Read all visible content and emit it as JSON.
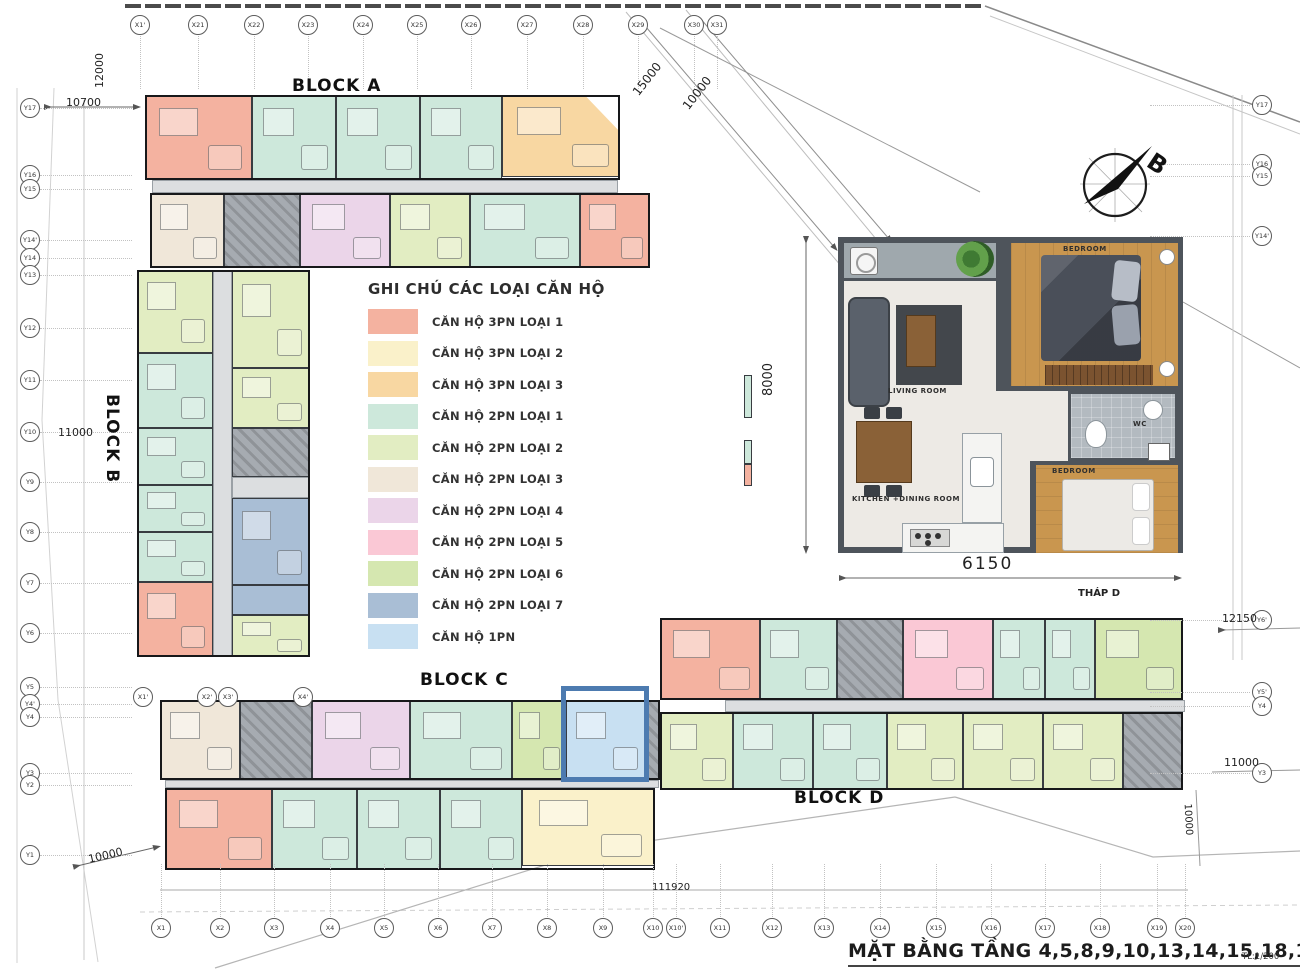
{
  "title": {
    "text": "MẶT BẰNG TẦNG 4,5,8,9,10,13,14,15,18,19,20",
    "scale": "TL:1/200"
  },
  "blocks": {
    "a": "BLOCK A",
    "b": "BLOCK B",
    "c": "BLOCK C",
    "d": "BLOCK D"
  },
  "north": {
    "label": "B"
  },
  "legend": {
    "title": "GHI CHÚ CÁC LOẠI CĂN HỘ",
    "items": [
      {
        "label": "CĂN HỘ 3PN LOẠI 1",
        "key": "3pn1",
        "color": "#f4b2a0"
      },
      {
        "label": "CĂN HỘ 3PN LOẠI 2",
        "key": "3pn2",
        "color": "#faf1ca"
      },
      {
        "label": "CĂN HỘ 3PN LOẠI 3",
        "key": "3pn3",
        "color": "#f8d7a2"
      },
      {
        "label": "CĂN HỘ 2PN LOẠI 1",
        "key": "2pn1",
        "color": "#cde8db"
      },
      {
        "label": "CĂN HỘ 2PN LOẠI 2",
        "key": "2pn2",
        "color": "#e2edc2"
      },
      {
        "label": "CĂN HỘ 2PN LOẠI 3",
        "key": "2pn3",
        "color": "#f0e7d9"
      },
      {
        "label": "CĂN HỘ 2PN LOẠI 4",
        "key": "2pn4",
        "color": "#ebd5e9"
      },
      {
        "label": "CĂN HỘ 2PN LOẠI 5",
        "key": "2pn5",
        "color": "#fac8d5"
      },
      {
        "label": "CĂN HỘ 2PN LOẠI 6",
        "key": "2pn6",
        "color": "#d5e7b0"
      },
      {
        "label": "CĂN HỘ 2PN LOẠI 7",
        "key": "2pn7",
        "color": "#a9bed5"
      },
      {
        "label": "CĂN HỘ 1PN",
        "key": "1pn",
        "color": "#c8e0f2"
      }
    ]
  },
  "detail": {
    "rooms": {
      "living": "LIVING ROOM",
      "kitchen": "KITCHEN +DINING ROOM",
      "bedroom": "BEDROOM",
      "wc": "WC"
    },
    "width_dim": "6150",
    "height_dim": "8000",
    "tower": "THÁP D"
  },
  "dims": {
    "top_vert": "12000",
    "left_top": "10700",
    "left_mid": "11000",
    "left_bottom": "10000",
    "diag_a": "15000",
    "diag_b": "10000",
    "right_top": "12150",
    "right_mid": "11000",
    "right_vert": "10000",
    "bottom_total": "111920"
  },
  "axes": {
    "top": [
      [
        "X1'",
        140
      ],
      [
        "X21",
        198
      ],
      [
        "X22",
        254
      ],
      [
        "X23",
        308
      ],
      [
        "X24",
        363
      ],
      [
        "X25",
        417
      ],
      [
        "X26",
        471
      ],
      [
        "X27",
        527
      ],
      [
        "X28",
        583
      ],
      [
        "X29",
        638
      ],
      [
        "X30",
        694
      ],
      [
        "X31",
        717
      ]
    ],
    "top_y": 25,
    "bottom": [
      [
        "X1",
        161
      ],
      [
        "X2",
        220
      ],
      [
        "X3",
        274
      ],
      [
        "X4",
        330
      ],
      [
        "X5",
        384
      ],
      [
        "X6",
        438
      ],
      [
        "X7",
        492
      ],
      [
        "X8",
        547
      ],
      [
        "X9",
        603
      ],
      [
        "X10",
        653
      ],
      [
        "X10'",
        676
      ],
      [
        "X11",
        720
      ],
      [
        "X12",
        772
      ],
      [
        "X13",
        824
      ],
      [
        "X14",
        880
      ],
      [
        "X15",
        936
      ],
      [
        "X16",
        991
      ],
      [
        "X17",
        1045
      ],
      [
        "X18",
        1100
      ],
      [
        "X19",
        1157
      ],
      [
        "X20",
        1185
      ]
    ],
    "bottom_y": 928,
    "left": [
      [
        "Y17",
        108
      ],
      [
        "Y16",
        175
      ],
      [
        "Y15",
        189
      ],
      [
        "Y14'",
        240
      ],
      [
        "Y14",
        258
      ],
      [
        "Y13",
        275
      ],
      [
        "Y12",
        328
      ],
      [
        "Y11",
        380
      ],
      [
        "Y10",
        432
      ],
      [
        "Y9",
        482
      ],
      [
        "Y8",
        532
      ],
      [
        "Y7",
        583
      ],
      [
        "Y6",
        633
      ],
      [
        "Y5",
        687
      ],
      [
        "Y4'",
        704
      ],
      [
        "Y4",
        717
      ],
      [
        "Y3",
        773
      ],
      [
        "Y2",
        785
      ],
      [
        "Y1",
        855
      ]
    ],
    "left_x": 30,
    "right": [
      [
        "Y17",
        105
      ],
      [
        "Y16",
        164
      ],
      [
        "Y15",
        176
      ],
      [
        "Y14'",
        236
      ],
      [
        "Y6'",
        620
      ],
      [
        "Y5'",
        692
      ],
      [
        "Y4",
        706
      ],
      [
        "Y3",
        773
      ]
    ],
    "right_x": 1262,
    "mid": [
      [
        "X1'",
        143,
        697
      ],
      [
        "X2'",
        207,
        697
      ],
      [
        "X3'",
        228,
        697
      ],
      [
        "X4'",
        303,
        697
      ]
    ]
  },
  "plan": {
    "colors": {
      "3pn1": "#f4b2a0",
      "3pn2": "#faf1ca",
      "3pn3": "#f8d7a2",
      "2pn1": "#cde8db",
      "2pn2": "#e2edc2",
      "2pn3": "#f0e7d9",
      "2pn4": "#ebd5e9",
      "2pn5": "#fac8d5",
      "2pn6": "#d5e7b0",
      "2pn7": "#a9bed5",
      "1pn": "#c8e0f2",
      "core": "#a6abb1",
      "corr": "#dcdee0"
    },
    "units": [
      [
        145,
        95,
        107,
        85,
        "3pn1"
      ],
      [
        252,
        95,
        84,
        85,
        "2pn1"
      ],
      [
        336,
        95,
        84,
        85,
        "2pn1"
      ],
      [
        420,
        95,
        82,
        85,
        "2pn1"
      ],
      [
        502,
        95,
        118,
        82,
        "3pn3",
        "polygon(0 0,70% 0,100% 45%,100% 100%,0 100%)"
      ],
      [
        152,
        180,
        466,
        13,
        "corr"
      ],
      [
        150,
        193,
        74,
        75,
        "2pn3"
      ],
      [
        224,
        193,
        76,
        75,
        "core"
      ],
      [
        300,
        193,
        90,
        75,
        "2pn4"
      ],
      [
        390,
        193,
        80,
        75,
        "2pn2"
      ],
      [
        470,
        193,
        110,
        75,
        "2pn1"
      ],
      [
        580,
        193,
        70,
        75,
        "3pn1"
      ],
      [
        213,
        270,
        19,
        387,
        "corr"
      ],
      [
        137,
        270,
        76,
        83,
        "2pn2"
      ],
      [
        137,
        353,
        76,
        75,
        "2pn1"
      ],
      [
        137,
        428,
        76,
        57,
        "2pn1"
      ],
      [
        137,
        485,
        76,
        47,
        "2pn1"
      ],
      [
        137,
        532,
        76,
        50,
        "2pn1"
      ],
      [
        137,
        582,
        76,
        75,
        "3pn1"
      ],
      [
        232,
        270,
        78,
        98,
        "2pn2"
      ],
      [
        232,
        368,
        78,
        60,
        "2pn2"
      ],
      [
        232,
        428,
        78,
        49,
        "core"
      ],
      [
        232,
        477,
        78,
        21,
        "corr"
      ],
      [
        232,
        498,
        78,
        87,
        "2pn7"
      ],
      [
        232,
        585,
        78,
        30,
        "2pn7"
      ],
      [
        232,
        615,
        78,
        42,
        "2pn2"
      ],
      [
        160,
        700,
        80,
        80,
        "2pn3"
      ],
      [
        240,
        700,
        72,
        80,
        "core"
      ],
      [
        312,
        700,
        98,
        80,
        "2pn4"
      ],
      [
        410,
        700,
        102,
        80,
        "2pn1"
      ],
      [
        512,
        700,
        54,
        80,
        "2pn6"
      ],
      [
        566,
        700,
        80,
        80,
        "1pn"
      ],
      [
        646,
        700,
        14,
        80,
        "core"
      ],
      [
        165,
        780,
        494,
        8,
        "corr"
      ],
      [
        165,
        788,
        107,
        82,
        "3pn1"
      ],
      [
        272,
        788,
        85,
        82,
        "2pn1"
      ],
      [
        357,
        788,
        83,
        82,
        "2pn1"
      ],
      [
        440,
        788,
        82,
        82,
        "2pn1"
      ],
      [
        522,
        788,
        133,
        78,
        "3pn2"
      ],
      [
        660,
        618,
        100,
        82,
        "3pn1"
      ],
      [
        760,
        618,
        77,
        82,
        "2pn1"
      ],
      [
        837,
        618,
        66,
        82,
        "core"
      ],
      [
        903,
        618,
        90,
        82,
        "2pn5"
      ],
      [
        993,
        618,
        52,
        82,
        "2pn1"
      ],
      [
        1045,
        618,
        50,
        82,
        "2pn1"
      ],
      [
        1095,
        618,
        88,
        82,
        "2pn6"
      ],
      [
        725,
        700,
        460,
        12,
        "corr"
      ],
      [
        660,
        712,
        73,
        78,
        "2pn2"
      ],
      [
        733,
        712,
        80,
        78,
        "2pn1"
      ],
      [
        813,
        712,
        74,
        78,
        "2pn1"
      ],
      [
        887,
        712,
        76,
        78,
        "2pn2"
      ],
      [
        963,
        712,
        80,
        78,
        "2pn2"
      ],
      [
        1043,
        712,
        80,
        78,
        "2pn2"
      ],
      [
        1123,
        712,
        60,
        78,
        "core"
      ],
      [
        744,
        375,
        8,
        43,
        "2pn1"
      ],
      [
        744,
        440,
        8,
        24,
        "2pn1"
      ],
      [
        744,
        464,
        8,
        22,
        "3pn1"
      ]
    ],
    "outlines": [
      [
        145,
        95,
        475,
        85
      ],
      [
        150,
        193,
        500,
        75
      ],
      [
        137,
        270,
        173,
        387
      ],
      [
        160,
        700,
        500,
        80
      ],
      [
        165,
        788,
        490,
        82
      ],
      [
        660,
        618,
        523,
        82
      ],
      [
        660,
        712,
        523,
        78
      ]
    ]
  }
}
